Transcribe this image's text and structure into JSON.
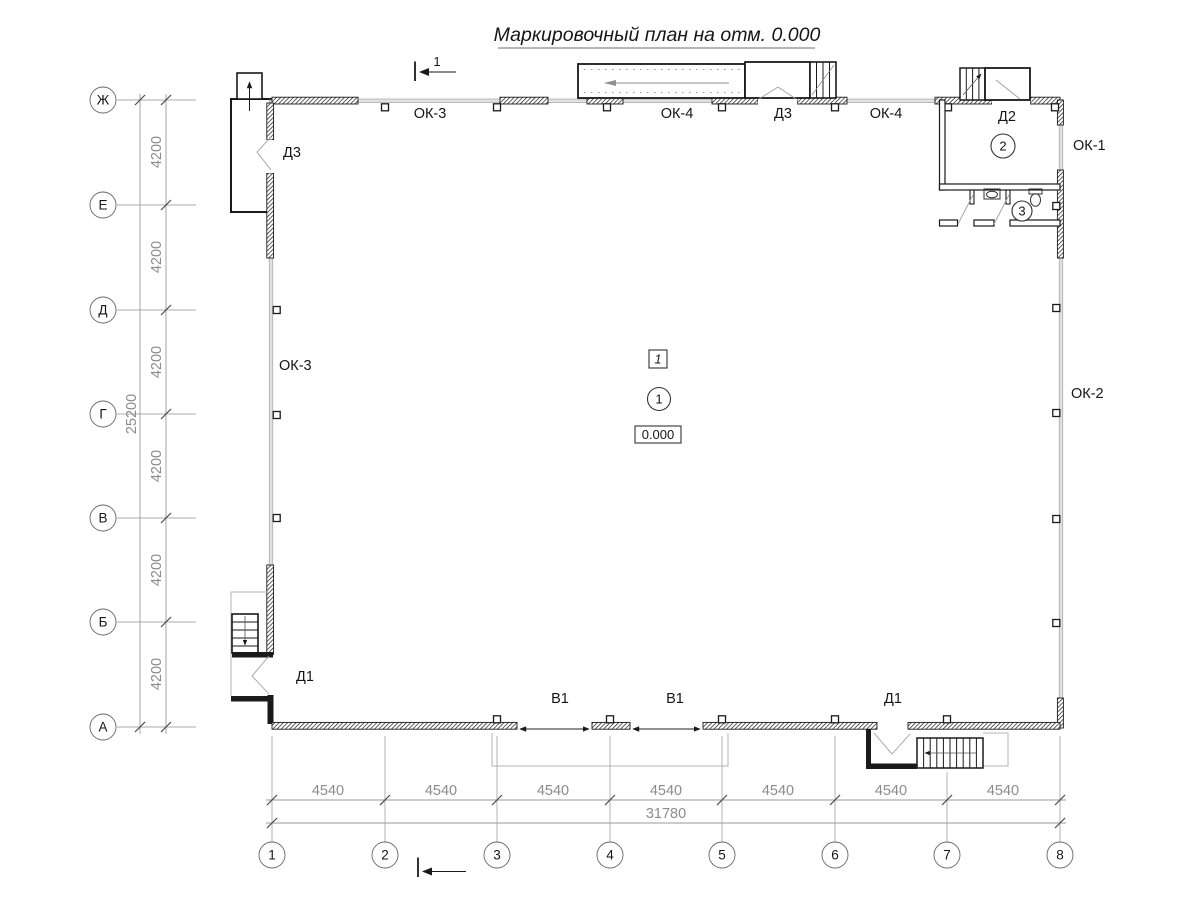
{
  "title": "Маркировочный план на отм. 0.000",
  "section_marks": {
    "top_label": "1"
  },
  "axes": {
    "rows": [
      "Ж",
      "Е",
      "Д",
      "Г",
      "В",
      "Б",
      "А"
    ],
    "cols": [
      "1",
      "2",
      "3",
      "4",
      "5",
      "6",
      "7",
      "8"
    ]
  },
  "dims": {
    "row_spacing": "4200",
    "rows_total": "25200",
    "col_spacing": "4540",
    "cols_total": "31780"
  },
  "marks": {
    "window_ok1": "ОК-1",
    "window_ok2": "ОК-2",
    "window_ok3": "ОК-3",
    "window_ok4": "ОК-4",
    "door_d1": "Д1",
    "door_d2": "Д2",
    "door_d3": "Д3",
    "gate_v1": "В1"
  },
  "rooms": {
    "room1_number": "1",
    "room2_number": "2",
    "room3_number": "3",
    "zone_number": "1",
    "elevation": "0.000"
  },
  "colors": {
    "wall": "#1a1a1a",
    "glazing": "#e0e0e0",
    "dimension": "#8c8c8c",
    "door_swing": "#9f9f9f"
  }
}
